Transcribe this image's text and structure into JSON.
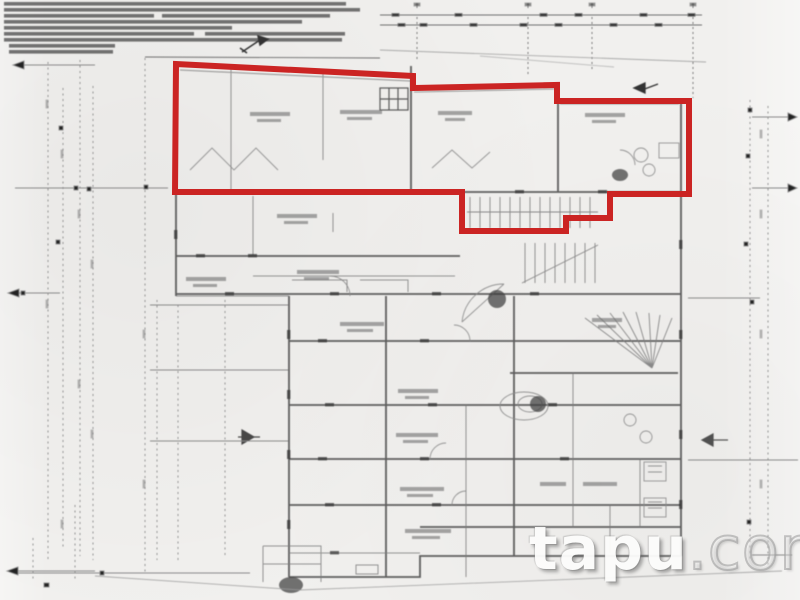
{
  "page": {
    "description": "scanned architectural floor plan with one apartment unit outlined in red",
    "background": "#f1f0ee"
  },
  "watermark": {
    "primary": "tapu",
    "suffix": ".com"
  },
  "red_outline": {
    "color": "#cb2423",
    "stroke_width": 6,
    "points": "176,64 413,76 413,88 557,85 557,101 689,101 689,194 610,194 610,218 566,218 566,231 462,231 462,192 175,192"
  },
  "notes_block": {
    "legible": false,
    "line_count": 9
  },
  "drawing": {
    "wall_color": "#4a4a4a",
    "faint_line_color": "#8a8a8a",
    "room_labels_legible": false
  }
}
